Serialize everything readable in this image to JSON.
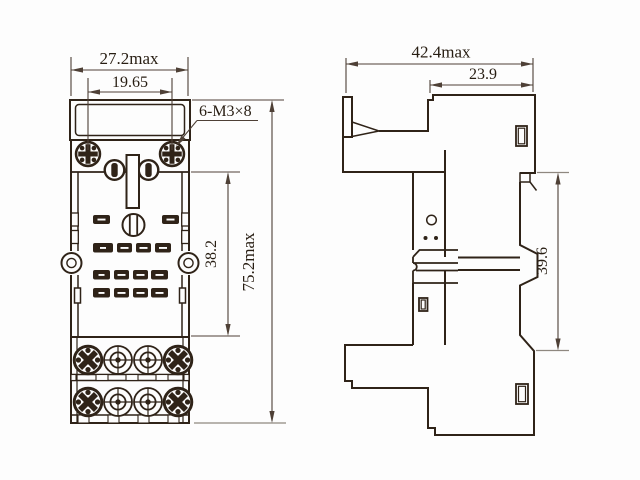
{
  "drawing": {
    "title": "Relay socket outline dimension drawing",
    "views": {
      "front": {
        "dims": {
          "overall_width": "27.2max",
          "mounting_hole_pitch": "19.65",
          "mounting_screw_callout": "6-M3×8",
          "contact_zone_height": "38.2",
          "overall_height": "75.2max"
        }
      },
      "side": {
        "dims": {
          "overall_depth": "42.4max",
          "upper_body_depth": "23.9",
          "din_rail_height": "39.6"
        }
      }
    },
    "colors": {
      "outline": "#2f2318",
      "dimension": "#4e4036",
      "extension_gray": "#8f8880",
      "background": "#fdfdfd"
    }
  }
}
